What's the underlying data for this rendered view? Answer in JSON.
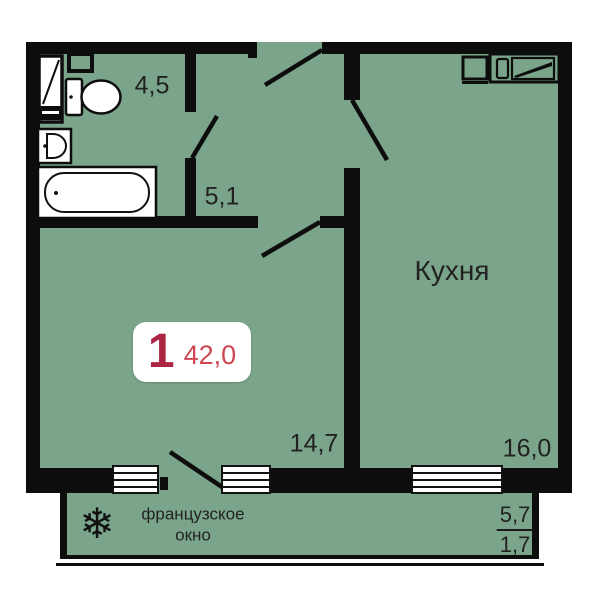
{
  "plan": {
    "badge": {
      "rooms_count": "1",
      "total_area": "42,0"
    },
    "rooms": {
      "bathroom": {
        "area": "4,5"
      },
      "hallway": {
        "area": "5,1"
      },
      "living": {
        "area": "14,7"
      },
      "kitchen": {
        "name": "Кухня",
        "area": "16,0"
      }
    },
    "balcony": {
      "feature_line1": "французское",
      "feature_line2": "окно",
      "area_total": "5,7",
      "area_reduced": "1,7",
      "snowflake_icon": "❄"
    },
    "colors": {
      "floor": "#7aa58a",
      "wall": "#0d0d0d",
      "rooms_accent": "#ac2643",
      "area_accent": "#cf4653"
    }
  }
}
